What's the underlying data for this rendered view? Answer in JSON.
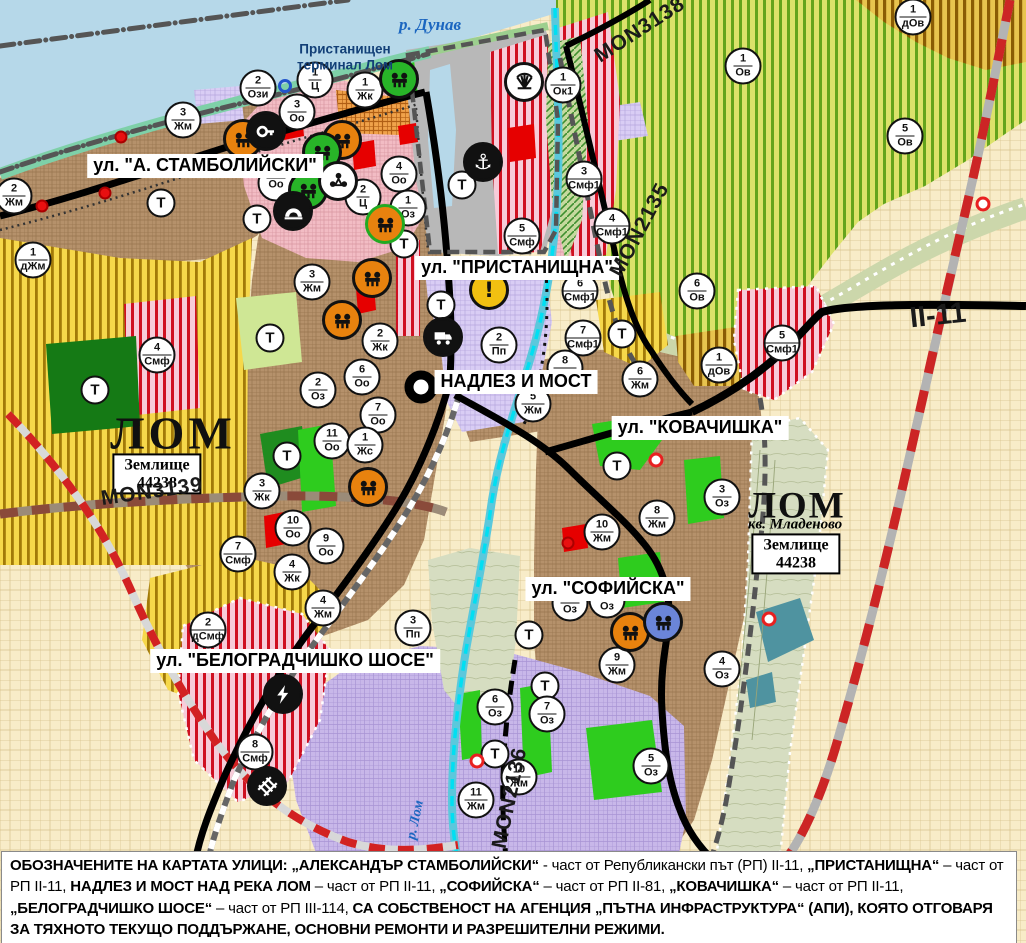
{
  "map_title": "Общ устройствен план - гр. Лом",
  "colors": {
    "water": "#b6d8e9",
    "urban_brown": "#b5916b",
    "residential_pink": "#f2bcc4",
    "industry_purple": "#c8b7e9",
    "agri_yellow": "#f6d84a",
    "vineyard_green": "#64a41c",
    "production_red_stripe": "#cf1021",
    "park_green": "#2ecc1e",
    "river_cyan": "#00dff2",
    "road_black": "#000000",
    "boundary_red_dash": "#cc2525",
    "port_gray": "#b8b8b8"
  },
  "street_labels": [
    {
      "text": "ул. \"А. СТАМБОЛИЙСКИ\"",
      "x": 205,
      "y": 166
    },
    {
      "text": "ул. \"ПРИСТАНИЩНА\"",
      "x": 517,
      "y": 268
    },
    {
      "text": "НАДЛЕЗ И МОСТ",
      "x": 516,
      "y": 382
    },
    {
      "text": "ул. \"КОВАЧИШКА\"",
      "x": 700,
      "y": 428
    },
    {
      "text": "ул. \"СОФИЙСКА\"",
      "x": 608,
      "y": 589
    },
    {
      "text": "ул. \"БЕЛОГРАДЧИШКО ШОСЕ\"",
      "x": 295,
      "y": 661
    }
  ],
  "place_labels": {
    "river": {
      "text": "р. Дунав",
      "x": 430,
      "y": 25
    },
    "terminal": {
      "text": "Пристанищен\nтерминал Лом",
      "x": 345,
      "y": 57
    },
    "cities": [
      {
        "text": "ЛОМ",
        "x": 173,
        "y": 433,
        "small": false
      },
      {
        "text": "ЛОМ",
        "x": 797,
        "y": 506,
        "small": true
      }
    ],
    "district": {
      "text": "кв. Младеново",
      "x": 795,
      "y": 525
    },
    "land_boxes": [
      {
        "line1": "Землище",
        "line2": "44238",
        "x": 157,
        "y": 474
      },
      {
        "line1": "Землище",
        "line2": "44238",
        "x": 796,
        "y": 554
      }
    ],
    "river_vertical": {
      "text": "р. Лом",
      "x": 416,
      "y": 820,
      "rot": -78
    }
  },
  "road_refs": [
    {
      "text": "MON3139",
      "x": 152,
      "y": 492,
      "rot": -8,
      "big": false
    },
    {
      "text": "MON3138",
      "x": 640,
      "y": 30,
      "rot": -33,
      "big": false
    },
    {
      "text": "MON2135",
      "x": 640,
      "y": 230,
      "rot": -62,
      "big": false
    },
    {
      "text": "MON2136",
      "x": 510,
      "y": 798,
      "rot": -78,
      "big": false
    },
    {
      "text": "II-11",
      "x": 938,
      "y": 316,
      "rot": -6,
      "big": true
    }
  ],
  "zone_markers": [
    {
      "num": "2",
      "code": "Жм",
      "x": 14,
      "y": 196
    },
    {
      "num": "1",
      "code": "дЖм",
      "x": 33,
      "y": 260
    },
    {
      "num": "",
      "code": "Т",
      "x": 161,
      "y": 203
    },
    {
      "num": "3",
      "code": "Жм",
      "x": 183,
      "y": 120
    },
    {
      "num": "",
      "code": "Т",
      "x": 257,
      "y": 219
    },
    {
      "num": "2",
      "code": "Ози",
      "x": 258,
      "y": 88
    },
    {
      "num": "3",
      "code": "Оо",
      "x": 297,
      "y": 112
    },
    {
      "num": "1",
      "code": "Ц",
      "x": 315,
      "y": 80
    },
    {
      "num": "1",
      "code": "Жк",
      "x": 365,
      "y": 90
    },
    {
      "num": "",
      "code": "Оо",
      "x": 276,
      "y": 183
    },
    {
      "num": "4",
      "code": "Оо",
      "x": 399,
      "y": 174
    },
    {
      "num": "2",
      "code": "Ц",
      "x": 363,
      "y": 197
    },
    {
      "num": "1",
      "code": "Оз",
      "x": 408,
      "y": 208
    },
    {
      "num": "",
      "code": "Т",
      "x": 404,
      "y": 244
    },
    {
      "num": "4",
      "code": "Смф",
      "x": 157,
      "y": 355
    },
    {
      "num": "",
      "code": "Т",
      "x": 95,
      "y": 390
    },
    {
      "num": "3",
      "code": "Жм",
      "x": 312,
      "y": 282
    },
    {
      "num": "",
      "code": "Т",
      "x": 270,
      "y": 338
    },
    {
      "num": "2",
      "code": "Жк",
      "x": 380,
      "y": 341
    },
    {
      "num": "2",
      "code": "Оз",
      "x": 318,
      "y": 390
    },
    {
      "num": "6",
      "code": "Оо",
      "x": 362,
      "y": 377
    },
    {
      "num": "7",
      "code": "Оо",
      "x": 378,
      "y": 415
    },
    {
      "num": "11",
      "code": "Оо",
      "x": 332,
      "y": 441
    },
    {
      "num": "1",
      "code": "Жс",
      "x": 365,
      "y": 445
    },
    {
      "num": "",
      "code": "Т",
      "x": 287,
      "y": 456
    },
    {
      "num": "3",
      "code": "Жк",
      "x": 262,
      "y": 491
    },
    {
      "num": "10",
      "code": "Оо",
      "x": 293,
      "y": 528
    },
    {
      "num": "9",
      "code": "Оо",
      "x": 326,
      "y": 546
    },
    {
      "num": "4",
      "code": "Жк",
      "x": 292,
      "y": 572
    },
    {
      "num": "7",
      "code": "Смф",
      "x": 238,
      "y": 554
    },
    {
      "num": "",
      "code": "Т",
      "x": 441,
      "y": 305
    },
    {
      "num": "2",
      "code": "Пп",
      "x": 499,
      "y": 345
    },
    {
      "num": "",
      "code": "Т",
      "x": 462,
      "y": 185
    },
    {
      "num": "5",
      "code": "Смф",
      "x": 522,
      "y": 236
    },
    {
      "num": "3",
      "code": "Смф1",
      "x": 584,
      "y": 179
    },
    {
      "num": "4",
      "code": "Смф1",
      "x": 612,
      "y": 226
    },
    {
      "num": "6",
      "code": "Смф1",
      "x": 580,
      "y": 291
    },
    {
      "num": "7",
      "code": "Смф1",
      "x": 583,
      "y": 338
    },
    {
      "num": "1",
      "code": "Ок1",
      "x": 563,
      "y": 85
    },
    {
      "num": "8",
      "code": "Жм",
      "x": 565,
      "y": 368
    },
    {
      "num": "5",
      "code": "Жм",
      "x": 533,
      "y": 404
    },
    {
      "num": "6",
      "code": "Жм",
      "x": 640,
      "y": 379
    },
    {
      "num": "1",
      "code": "Ов",
      "x": 743,
      "y": 66
    },
    {
      "num": "5",
      "code": "Ов",
      "x": 905,
      "y": 136
    },
    {
      "num": "1",
      "code": "дОв",
      "x": 913,
      "y": 17
    },
    {
      "num": "6",
      "code": "Ов",
      "x": 697,
      "y": 291
    },
    {
      "num": "1",
      "code": "дОв",
      "x": 719,
      "y": 365
    },
    {
      "num": "5",
      "code": "Смф1",
      "x": 782,
      "y": 343
    },
    {
      "num": "",
      "code": "Т",
      "x": 622,
      "y": 334
    },
    {
      "num": "",
      "code": "Т",
      "x": 617,
      "y": 466
    },
    {
      "num": "3",
      "code": "Оз",
      "x": 722,
      "y": 497
    },
    {
      "num": "8",
      "code": "Жм",
      "x": 657,
      "y": 518
    },
    {
      "num": "10",
      "code": "Жм",
      "x": 602,
      "y": 532
    },
    {
      "num": "1",
      "code": "Оз",
      "x": 570,
      "y": 603
    },
    {
      "num": "2",
      "code": "Оз",
      "x": 607,
      "y": 600
    },
    {
      "num": "",
      "code": "Т",
      "x": 529,
      "y": 635
    },
    {
      "num": "9",
      "code": "Жм",
      "x": 617,
      "y": 665
    },
    {
      "num": "4",
      "code": "Оз",
      "x": 722,
      "y": 669
    },
    {
      "num": "",
      "code": "Т",
      "x": 545,
      "y": 686
    },
    {
      "num": "6",
      "code": "Оз",
      "x": 495,
      "y": 707
    },
    {
      "num": "7",
      "code": "Оз",
      "x": 547,
      "y": 714
    },
    {
      "num": "",
      "code": "Т",
      "x": 495,
      "y": 754
    },
    {
      "num": "10",
      "code": "Жм",
      "x": 519,
      "y": 777
    },
    {
      "num": "11",
      "code": "Жм",
      "x": 476,
      "y": 800
    },
    {
      "num": "5",
      "code": "Оз",
      "x": 651,
      "y": 766
    },
    {
      "num": "2",
      "code": "дСмф",
      "x": 208,
      "y": 630
    },
    {
      "num": "4",
      "code": "Жм",
      "x": 323,
      "y": 608
    },
    {
      "num": "3",
      "code": "Пп",
      "x": 413,
      "y": 628
    },
    {
      "num": "8",
      "code": "Смф",
      "x": 255,
      "y": 752
    }
  ],
  "poi_styles": {
    "orange": {
      "bg": "#e8820e",
      "ring": "#111111",
      "glyph": "#111111"
    },
    "orange-green": {
      "bg": "#e8820e",
      "ring": "#22aa22",
      "glyph": "#111111"
    },
    "green": {
      "bg": "#28b428",
      "ring": "#111111",
      "glyph": "#111111"
    },
    "blue": {
      "bg": "#6b85d8",
      "ring": "#111111",
      "glyph": "#111111"
    },
    "black": {
      "bg": "#111111",
      "ring": "#111111",
      "glyph": "#ffffff"
    },
    "white": {
      "bg": "#ffffff",
      "ring": "#111111",
      "glyph": "#111111"
    },
    "yellow": {
      "bg": "#f2c011",
      "ring": "#111111",
      "glyph": "#111111"
    }
  },
  "poi_markers": [
    {
      "icon": "ruin",
      "style": "orange",
      "x": 243,
      "y": 139
    },
    {
      "icon": "ruin",
      "style": "orange",
      "x": 342,
      "y": 140
    },
    {
      "icon": "ruin",
      "style": "orange",
      "x": 372,
      "y": 278
    },
    {
      "icon": "ruin",
      "style": "orange",
      "x": 342,
      "y": 320
    },
    {
      "icon": "ruin",
      "style": "orange",
      "x": 368,
      "y": 487
    },
    {
      "icon": "ruin",
      "style": "orange",
      "x": 630,
      "y": 632
    },
    {
      "icon": "ruin",
      "style": "orange-green",
      "x": 385,
      "y": 224
    },
    {
      "icon": "ruin",
      "style": "green",
      "x": 322,
      "y": 152
    },
    {
      "icon": "ruin",
      "style": "green",
      "x": 308,
      "y": 190
    },
    {
      "icon": "ruin",
      "style": "green",
      "x": 399,
      "y": 79
    },
    {
      "icon": "ruin",
      "style": "blue",
      "x": 663,
      "y": 622
    },
    {
      "icon": "key",
      "style": "black",
      "x": 266,
      "y": 131
    },
    {
      "icon": "trio",
      "style": "white",
      "x": 338,
      "y": 181
    },
    {
      "icon": "tunnel",
      "style": "black",
      "x": 293,
      "y": 211
    },
    {
      "icon": "anchor",
      "style": "black",
      "x": 483,
      "y": 162
    },
    {
      "icon": "truck",
      "style": "black",
      "x": 443,
      "y": 337
    },
    {
      "icon": "bolt",
      "style": "black",
      "x": 283,
      "y": 694
    },
    {
      "icon": "rail",
      "style": "black",
      "x": 267,
      "y": 786
    },
    {
      "icon": "sunfan",
      "style": "white",
      "x": 524,
      "y": 82
    },
    {
      "icon": "bang",
      "style": "yellow",
      "x": 489,
      "y": 290
    }
  ],
  "point_markers": {
    "red": [
      [
        121,
        137
      ],
      [
        105,
        193
      ],
      [
        42,
        206
      ],
      [
        568,
        543
      ]
    ],
    "red_white": [
      [
        656,
        460
      ],
      [
        769,
        619
      ],
      [
        477,
        761
      ],
      [
        983,
        204
      ]
    ],
    "blue_ring": [
      [
        285,
        86
      ]
    ]
  },
  "footer": {
    "segments": [
      {
        "t": "ОБОЗНАЧЕНИТЕ НА КАРТАТА УЛИЦИ: „АЛЕКСАНДЪР СТАМБОЛИЙСКИ“",
        "b": true
      },
      {
        "t": " - част от Републикански път (РП) II-11, ",
        "b": false
      },
      {
        "t": "„ПРИСТАНИЩНА“",
        "b": true
      },
      {
        "t": " – част от РП II-11, ",
        "b": false
      },
      {
        "t": "НАДЛЕЗ И МОСТ НАД РЕКА ЛОМ",
        "b": true
      },
      {
        "t": " – част от РП II-11, ",
        "b": false
      },
      {
        "t": "„СОФИЙСКА“",
        "b": true
      },
      {
        "t": " – част от РП II-81, ",
        "b": false
      },
      {
        "t": "„КОВАЧИШКА“",
        "b": true
      },
      {
        "t": " – част от РП II-11, ",
        "b": false
      },
      {
        "t": "„БЕЛОГРАДЧИШКО ШОСЕ“",
        "b": true
      },
      {
        "t": " – част от РП III-114, ",
        "b": false
      },
      {
        "t": "СА СОБСТВЕНОСТ НА АГЕНЦИЯ „ПЪТНА ИНФРАСТРУКТУРА“ (АПИ), КОЯТО ОТГОВАРЯ ЗА ТЯХНОТО ТЕКУЩО ПОДДЪРЖАНЕ, ОСНОВНИ РЕМОНТИ И РАЗРЕШИТЕЛНИ РЕЖИМИ.",
        "b": true
      }
    ]
  }
}
